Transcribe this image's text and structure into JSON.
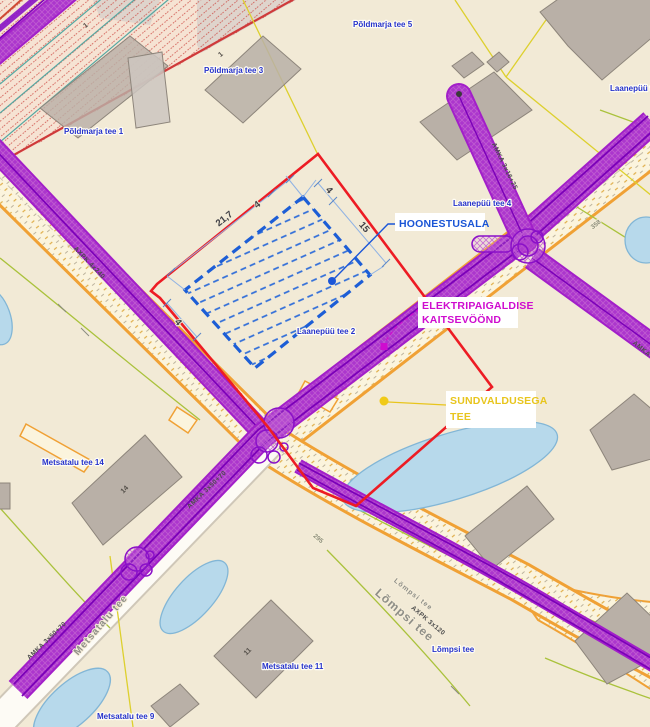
{
  "map": {
    "callouts": {
      "hoonestusala": {
        "label": "HOONESTUSALA"
      },
      "elektripaigaldise": {
        "line1": "ELEKTRIPAIGALDISE",
        "line2": "KAITSEVÖÖND"
      },
      "sundvaldusega": {
        "line1": "SUNDVALDUSEGA",
        "line2": "TEE"
      }
    },
    "addresses": {
      "poldmarja5": "Põldmarja tee 5",
      "poldmarja3": "Põldmarja tee 3",
      "poldmarja1": "Põldmarja tee 1",
      "laanepuu_top": "Laanepüü tee",
      "laanepuu4": "Laanepüü tee 4",
      "laanepuu2": "Laanepüü tee 2",
      "metsatalu14": "Metsatalu tee 14",
      "metsatalu11": "Metsatalu tee 11",
      "metsatalu9": "Metsatalu tee 9",
      "lompsi_addr": "Lõmpsi tee"
    },
    "road_names": {
      "lompsi": "Lõmpsi tee",
      "metsatalu": "Metsatalu tee"
    },
    "cable_labels": {
      "axpk4x240": "AXPK 4x240",
      "amka3x50": "AMKA 3x50+70",
      "amka3x16": "AMKA 3x16+25",
      "axpk3x120": "AXPK 3x120"
    },
    "plot_numbers": {
      "n358": "358",
      "n295": "295"
    },
    "building_numbers": {
      "b14": "14",
      "b11": "11",
      "b1": "1"
    },
    "dimensions": {
      "long_side": "21,7",
      "short_side": "15",
      "setback": "4"
    },
    "colors": {
      "background": "#f2ead6",
      "plan_boundary_red": "#ed1c24",
      "building_area_blue": "#1d5ed6",
      "protection_zone_magenta": "#cf0ccf",
      "sundvaldus_yellow": "#e8c51d",
      "corridor_purple": "#a21fc9",
      "road_edge_orange": "#f0a135",
      "pond_blue": "#b7d9eb",
      "cadastral_yellow": "#ddd02e",
      "building_gray": "#b9b0a7"
    }
  }
}
